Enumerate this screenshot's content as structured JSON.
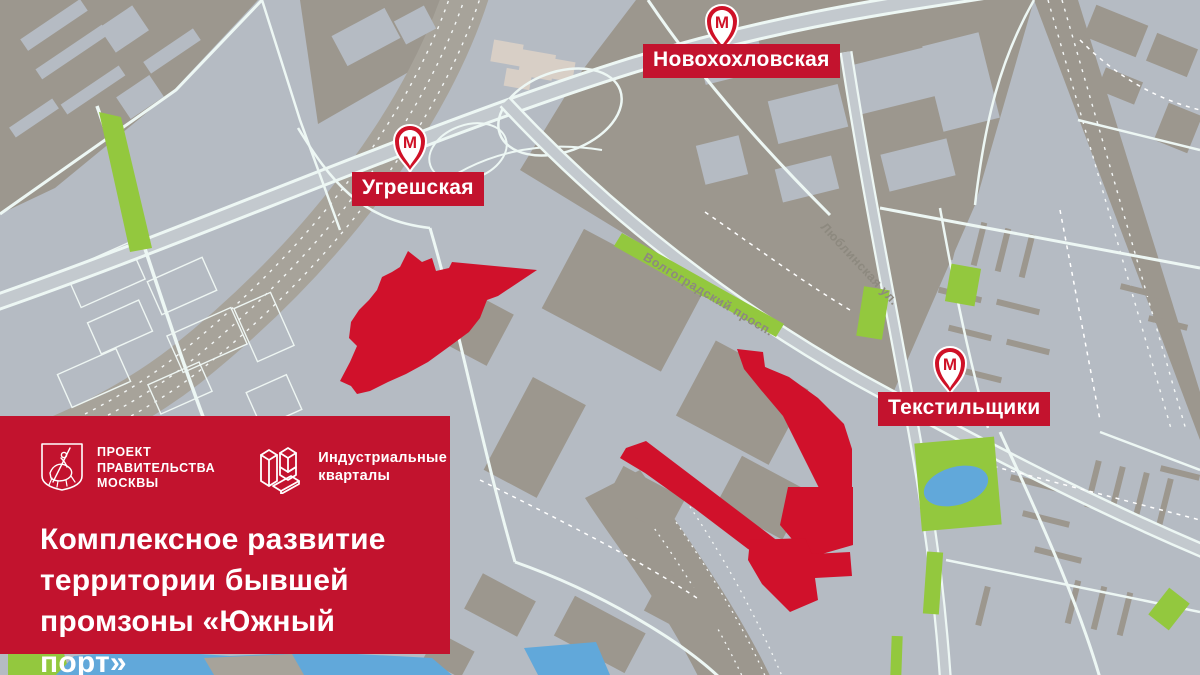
{
  "map": {
    "stations": [
      {
        "name": "Новохохловская",
        "metro_letter": "М"
      },
      {
        "name": "Угрешская",
        "metro_letter": "М"
      },
      {
        "name": "Текстильщики",
        "metro_letter": "М"
      }
    ],
    "road_labels": [
      {
        "name": "Волгоградский просп."
      },
      {
        "name": "Люблинская ул."
      }
    ],
    "colors": {
      "block_light": "#b5bbc3",
      "block_taupe": "#9c978e",
      "road_line": "#edf7f4",
      "green": "#93c83e",
      "water": "#61a8da",
      "redevelopment_zone": "#d0112b"
    }
  },
  "panel": {
    "background": "#c2132e",
    "gov": {
      "l1": "ПРОЕКТ",
      "l2": "ПРАВИТЕЛЬСТВА",
      "l3": "МОСКВЫ"
    },
    "brand": {
      "l1": "Индустриальные",
      "l2": "кварталы"
    },
    "title": {
      "l1": "Комплексное развитие",
      "l2": "территории бывшей",
      "l3": "промзоны «Южный порт»"
    }
  }
}
